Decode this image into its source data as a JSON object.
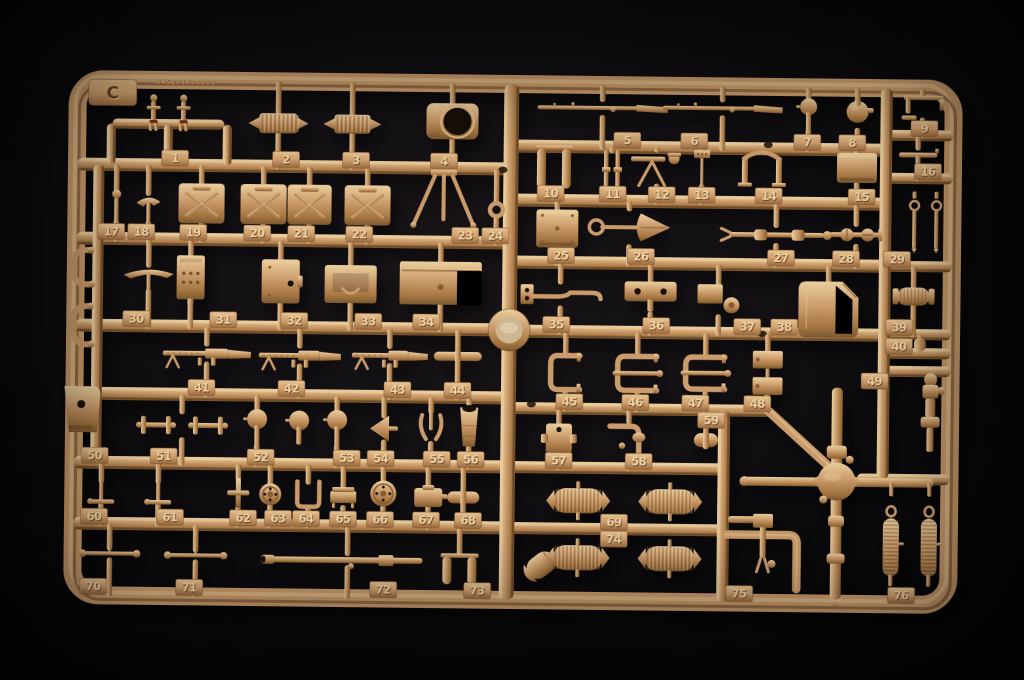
{
  "scene": {
    "title": "Photograph of a tan plastic model-kit sprue (parts tree) on a black background",
    "description": "Sand-tan injection-moulded sprue C holding numbered model parts 1 to 76"
  },
  "sprue": {
    "letter": "C",
    "embossed_code": "845291845293",
    "colors": {
      "plastic_light": "#eccf9e",
      "plastic_mid": "#cb9c6b",
      "plastic_dark": "#a3743f",
      "plastic_deep": "#7c5930",
      "tab_hi": "#e2bb87",
      "tab_light": "#d1a271",
      "tab_dark": "#9a6c3e",
      "rail_shade": "#4e3119",
      "engrave": "#684222",
      "engrave_hi": "#e8c48e",
      "digit_light": "#eed2a2",
      "digit_dark": "#6d452a",
      "accent_red": "#7e2818",
      "hole": "#171007",
      "boss_inner": "#cdb692",
      "background": "#0a090b"
    },
    "frame": {
      "x": 75,
      "y": 84,
      "w": 876,
      "h": 516,
      "rx": 26,
      "thickness": 18,
      "tilt_deg": 0.65
    },
    "boss": {
      "x": 509,
      "y": 330
    },
    "holes": [
      {
        "x": 501,
        "y": 170
      },
      {
        "x": 766,
        "y": 142
      },
      {
        "x": 762,
        "y": 331
      },
      {
        "x": 532,
        "y": 404
      }
    ],
    "rails_h": [
      {
        "x": 110,
        "y": 128,
        "len": 112,
        "w": 10
      },
      {
        "x": 75,
        "y": 169,
        "len": 434,
        "w": 13
      },
      {
        "x": 75,
        "y": 243,
        "len": 434,
        "w": 13
      },
      {
        "x": 75,
        "y": 330,
        "len": 434,
        "w": 13
      },
      {
        "x": 75,
        "y": 398,
        "len": 434,
        "w": 13
      },
      {
        "x": 75,
        "y": 467,
        "len": 434,
        "w": 13
      },
      {
        "x": 75,
        "y": 528,
        "len": 434,
        "w": 13
      },
      {
        "x": 509,
        "y": 146,
        "len": 375,
        "w": 13
      },
      {
        "x": 509,
        "y": 200,
        "len": 375,
        "w": 13
      },
      {
        "x": 509,
        "y": 262,
        "len": 375,
        "w": 13
      },
      {
        "x": 509,
        "y": 331,
        "len": 375,
        "w": 13
      },
      {
        "x": 509,
        "y": 408,
        "len": 263,
        "w": 12
      },
      {
        "x": 509,
        "y": 467,
        "len": 222,
        "w": 12
      },
      {
        "x": 509,
        "y": 528,
        "len": 222,
        "w": 12
      },
      {
        "x": 884,
        "y": 131,
        "len": 67,
        "w": 11
      },
      {
        "x": 884,
        "y": 174,
        "len": 67,
        "w": 11
      },
      {
        "x": 884,
        "y": 262,
        "len": 67,
        "w": 11
      },
      {
        "x": 884,
        "y": 330,
        "len": 67,
        "w": 11
      },
      {
        "x": 884,
        "y": 349,
        "len": 67,
        "w": 11
      },
      {
        "x": 884,
        "y": 367,
        "len": 67,
        "w": 11
      },
      {
        "x": 858,
        "y": 475,
        "len": 93,
        "w": 11
      }
    ],
    "rails_v": [
      {
        "x": 509,
        "y": 84,
        "len": 516,
        "w": 15
      },
      {
        "x": 884,
        "y": 84,
        "len": 391,
        "w": 12
      },
      {
        "x": 97,
        "y": 169,
        "len": 298,
        "w": 11
      },
      {
        "x": 725,
        "y": 408,
        "len": 192,
        "w": 12
      },
      {
        "x": 109,
        "y": 128,
        "len": 41,
        "w": 9
      },
      {
        "x": 166,
        "y": 128,
        "len": 41,
        "w": 9
      },
      {
        "x": 225,
        "y": 128,
        "len": 41,
        "w": 9
      }
    ],
    "rail_diag": {
      "x1": 768,
      "y1": 407,
      "x2": 836,
      "y2": 468,
      "w": 9
    },
    "parts": [
      {
        "n": 1,
        "t": "figures2",
        "x": 168,
        "y": 116,
        "w": 62,
        "h": 38,
        "ry": 169,
        "tx": 173,
        "ns": 1
      },
      {
        "n": 2,
        "t": "spring_h",
        "x": 276,
        "y": 126,
        "w": 60,
        "h": 20,
        "ry": 169,
        "tx": 284,
        "up": 84
      },
      {
        "n": 3,
        "t": "spring_h",
        "x": 350,
        "y": 126,
        "w": 58,
        "h": 19,
        "ry": 169,
        "tx": 354,
        "up": 84
      },
      {
        "n": 4,
        "t": "cupola",
        "x": 450,
        "y": 122,
        "w": 52,
        "h": 36,
        "ry": 169,
        "tx": 442,
        "up": 84
      },
      {
        "n": 5,
        "t": "rifle",
        "x": 600,
        "y": 107,
        "w": 130,
        "h": 18,
        "ry": 146,
        "tx": 625,
        "up": 84
      },
      {
        "n": 6,
        "t": "rifle",
        "x": 720,
        "y": 106,
        "w": 120,
        "h": 18,
        "ry": 146,
        "tx": 692,
        "up": 84
      },
      {
        "n": 7,
        "t": "ballstem",
        "x": 806,
        "y": 111,
        "w": 17,
        "h": 32,
        "ry": 146,
        "tx": 805,
        "up": 84
      },
      {
        "n": 8,
        "t": "grenade",
        "x": 855,
        "y": 110,
        "w": 26,
        "h": 32,
        "ry": 146,
        "tx": 850,
        "up": 84
      },
      {
        "n": 9,
        "t": "periscope",
        "x": 920,
        "y": 103,
        "w": 48,
        "h": 24,
        "ry": 131,
        "tx": 922,
        "up": 84
      },
      {
        "n": 10,
        "t": "twincyl",
        "x": 552,
        "y": 167,
        "w": 38,
        "h": 44,
        "ry": 200,
        "tx": 549,
        "up": 146,
        "ns": 1
      },
      {
        "n": 11,
        "t": "pins",
        "x": 610,
        "y": 169,
        "w": 28,
        "h": 40,
        "ry": 200,
        "tx": 611,
        "up": 146,
        "ns": 1
      },
      {
        "n": 12,
        "t": "mgmount",
        "x": 655,
        "y": 166,
        "w": 52,
        "h": 36,
        "ry": 200,
        "tx": 660,
        "up": 146
      },
      {
        "n": 13,
        "t": "flag",
        "x": 700,
        "y": 166,
        "w": 22,
        "h": 36,
        "ry": 200,
        "tx": 700,
        "up": 146
      },
      {
        "n": 14,
        "t": "ubracket",
        "x": 760,
        "y": 165,
        "w": 54,
        "h": 38,
        "ry": 200,
        "tx": 767,
        "up": 146,
        "ns": 1
      },
      {
        "n": 15,
        "t": "boxp",
        "x": 855,
        "y": 164,
        "w": 40,
        "h": 30,
        "ry": 200,
        "tx": 860,
        "up": 146
      },
      {
        "n": 16,
        "t": "tpart",
        "x": 916,
        "y": 153,
        "w": 44,
        "h": 20,
        "ry": 174,
        "tx": 926,
        "up": 131
      },
      {
        "n": 17,
        "t": "smallpin",
        "x": 115,
        "y": 210,
        "w": 14,
        "h": 32,
        "ry": 243,
        "tx": 110,
        "up": 169
      },
      {
        "n": 18,
        "t": "pick",
        "x": 147,
        "y": 212,
        "w": 24,
        "h": 30,
        "ry": 243,
        "tx": 140,
        "up": 169
      },
      {
        "n": 19,
        "t": "jerrycan",
        "x": 200,
        "y": 207,
        "w": 46,
        "h": 40,
        "ry": 243,
        "tx": 192,
        "up": 169
      },
      {
        "n": 20,
        "t": "jerrycan",
        "x": 262,
        "y": 207,
        "w": 46,
        "h": 40,
        "ry": 243,
        "tx": 256,
        "up": 169
      },
      {
        "n": 21,
        "t": "jerrycan",
        "x": 308,
        "y": 207,
        "w": 44,
        "h": 40,
        "ry": 243,
        "tx": 300,
        "up": 169
      },
      {
        "n": 22,
        "t": "jerrycan",
        "x": 366,
        "y": 207,
        "w": 46,
        "h": 40,
        "ry": 243,
        "tx": 358,
        "up": 169
      },
      {
        "n": 23,
        "t": "tripod",
        "x": 442,
        "y": 198,
        "w": 68,
        "h": 56,
        "ry": 243,
        "tx": 464,
        "up": 169,
        "ns": 1
      },
      {
        "n": 24,
        "t": "ring",
        "x": 495,
        "y": 210,
        "w": 17,
        "h": 17,
        "ry": 243,
        "tx": 494,
        "up": 169
      },
      {
        "n": 25,
        "t": "rivetbox",
        "x": 556,
        "y": 228,
        "w": 42,
        "h": 38,
        "ry": 262,
        "tx": 560,
        "up": 200
      },
      {
        "n": 26,
        "t": "shovel",
        "x": 628,
        "y": 226,
        "w": 82,
        "h": 38,
        "ry": 262,
        "tx": 640,
        "up": 200
      },
      {
        "n": 27,
        "t": "linkage",
        "x": 775,
        "y": 232,
        "w": 110,
        "h": 20,
        "ry": 262,
        "tx": 780,
        "up": 200
      },
      {
        "n": 28,
        "t": "axlejoint",
        "x": 855,
        "y": 231,
        "w": 52,
        "h": 22,
        "ry": 262,
        "tx": 845,
        "up": 200
      },
      {
        "n": 29,
        "t": "eyebolts",
        "x": 924,
        "y": 222,
        "w": 40,
        "h": 52,
        "ry": 262,
        "tx": 896,
        "ns": 1
      },
      {
        "n": 30,
        "t": "pick",
        "x": 148,
        "y": 282,
        "w": 50,
        "h": 26,
        "ry": 330,
        "tx": 136,
        "up": 243
      },
      {
        "n": 31,
        "t": "radio",
        "x": 190,
        "y": 281,
        "w": 28,
        "h": 44,
        "ry": 330,
        "tx": 223,
        "up": 243
      },
      {
        "n": 32,
        "t": "hatch",
        "x": 280,
        "y": 284,
        "w": 38,
        "h": 44,
        "ry": 330,
        "tx": 294,
        "up": 243
      },
      {
        "n": 33,
        "t": "hatch2",
        "x": 350,
        "y": 286,
        "w": 52,
        "h": 38,
        "ry": 330,
        "tx": 368,
        "up": 243
      },
      {
        "n": 34,
        "t": "bin",
        "x": 440,
        "y": 284,
        "w": 82,
        "h": 43,
        "ry": 330,
        "tx": 426,
        "up": 243
      },
      {
        "n": 35,
        "t": "pipe",
        "x": 560,
        "y": 294,
        "w": 80,
        "h": 26,
        "ry": 331,
        "tx": 556,
        "up": 262
      },
      {
        "n": 36,
        "t": "holeplate",
        "x": 650,
        "y": 296,
        "w": 52,
        "h": 32,
        "ry": 331,
        "tx": 656,
        "up": 262
      },
      {
        "n": 37,
        "t": "wheelplate",
        "x": 718,
        "y": 298,
        "w": 42,
        "h": 32,
        "ry": 331,
        "tx": 747,
        "up": 262
      },
      {
        "n": 38,
        "t": "bigcan",
        "x": 828,
        "y": 306,
        "w": 60,
        "h": 56,
        "ry": 331,
        "tx": 784,
        "up": 262,
        "ns": 1
      },
      {
        "n": 39,
        "t": "ribadapter",
        "x": 913,
        "y": 292,
        "w": 42,
        "h": 18,
        "ry": 330,
        "tx": 899,
        "up": 262
      },
      {
        "n": 40,
        "t": "pin40",
        "x": 920,
        "y": 340,
        "w": 12,
        "h": 14,
        "ry": 349,
        "tx": 899,
        "up": 330
      },
      {
        "n": 41,
        "t": "mg",
        "x": 207,
        "y": 357,
        "w": 88,
        "h": 20,
        "ry": 398,
        "tx": 202,
        "up": 330
      },
      {
        "n": 42,
        "t": "mg",
        "x": 300,
        "y": 358,
        "w": 82,
        "h": 20,
        "ry": 398,
        "tx": 292,
        "up": 330
      },
      {
        "n": 43,
        "t": "mg",
        "x": 390,
        "y": 357,
        "w": 76,
        "h": 19,
        "ry": 398,
        "tx": 398,
        "up": 330
      },
      {
        "n": 44,
        "t": "rodshort",
        "x": 458,
        "y": 357,
        "w": 48,
        "h": 9,
        "ry": 398,
        "tx": 458,
        "up": 330
      },
      {
        "n": 45,
        "t": "cclamp",
        "x": 566,
        "y": 372,
        "w": 34,
        "h": 40,
        "ry": 408,
        "tx": 570,
        "up": 331
      },
      {
        "n": 46,
        "t": "clamp2",
        "x": 638,
        "y": 372,
        "w": 44,
        "h": 40,
        "ry": 408,
        "tx": 636,
        "up": 331
      },
      {
        "n": 47,
        "t": "clamp2",
        "x": 706,
        "y": 371,
        "w": 44,
        "h": 38,
        "ry": 408,
        "tx": 696,
        "up": 331
      },
      {
        "n": 48,
        "t": "dblbracket",
        "x": 768,
        "y": 370,
        "w": 30,
        "h": 44,
        "ry": 408,
        "tx": 758,
        "up": 331
      },
      {
        "n": 49,
        "t": "turnpiece",
        "x": 931,
        "y": 408,
        "w": 26,
        "h": 78,
        "ry": 367,
        "tx": 875,
        "tb": 1,
        "ns": 1
      },
      {
        "n": 50,
        "t": "bracket",
        "x": 83,
        "y": 414,
        "w": 36,
        "h": 46,
        "ry": 467,
        "tx": 96,
        "ns": 1
      },
      {
        "n": 51,
        "t": "hbars",
        "x": 183,
        "y": 429,
        "w": 96,
        "h": 28,
        "ry": 467,
        "tx": 165,
        "up": 398
      },
      {
        "n": 52,
        "t": "ballstem",
        "x": 258,
        "y": 430,
        "w": 22,
        "h": 36,
        "ry": 467,
        "tx": 262,
        "up": 398
      },
      {
        "n": 53,
        "t": "ballstem",
        "x": 338,
        "y": 430,
        "w": 20,
        "h": 36,
        "ry": 467,
        "tx": 348,
        "up": 398
      },
      {
        "n": 54,
        "t": "funnel",
        "x": 385,
        "y": 430,
        "w": 28,
        "h": 26,
        "ry": 467,
        "tx": 382,
        "up": 398
      },
      {
        "n": 55,
        "t": "claw",
        "x": 432,
        "y": 428,
        "w": 30,
        "h": 32,
        "ry": 467,
        "tx": 438,
        "up": 398
      },
      {
        "n": 56,
        "t": "muzzle",
        "x": 470,
        "y": 426,
        "w": 28,
        "h": 42,
        "ry": 467,
        "tx": 472,
        "up": 398
      },
      {
        "n": 57,
        "t": "jbox",
        "x": 560,
        "y": 438,
        "w": 36,
        "h": 30,
        "ry": 467,
        "tx": 560,
        "up": 408
      },
      {
        "n": 58,
        "t": "elbow2",
        "x": 630,
        "y": 437,
        "w": 38,
        "h": 34,
        "ry": 467,
        "tx": 640,
        "up": 408
      },
      {
        "n": 59,
        "t": "rodshort",
        "x": 707,
        "y": 438,
        "w": 24,
        "h": 14,
        "ry": 408,
        "tx": 712,
        "tb": 1,
        "up": 414
      },
      {
        "n": 60,
        "t": "lever",
        "x": 103,
        "y": 497,
        "w": 26,
        "h": 24,
        "ry": 528,
        "tx": 96,
        "up": 467
      },
      {
        "n": 61,
        "t": "lever",
        "x": 160,
        "y": 497,
        "w": 26,
        "h": 24,
        "ry": 528,
        "tx": 172,
        "up": 467
      },
      {
        "n": 62,
        "t": "cross",
        "x": 240,
        "y": 496,
        "w": 22,
        "h": 30,
        "ry": 528,
        "tx": 245,
        "up": 467
      },
      {
        "n": 63,
        "t": "wheelsm",
        "x": 272,
        "y": 497,
        "w": 22,
        "h": 22,
        "ry": 528,
        "tx": 280,
        "up": 467
      },
      {
        "n": 64,
        "t": "ubend",
        "x": 310,
        "y": 497,
        "w": 26,
        "h": 26,
        "ry": 528,
        "tx": 308,
        "up": 467
      },
      {
        "n": 65,
        "t": "pan",
        "x": 345,
        "y": 499,
        "w": 26,
        "h": 20,
        "ry": 528,
        "tx": 345,
        "up": 467
      },
      {
        "n": 66,
        "t": "wheelsm",
        "x": 385,
        "y": 495,
        "w": 26,
        "h": 26,
        "ry": 528,
        "tx": 382,
        "up": 467
      },
      {
        "n": 67,
        "t": "pot",
        "x": 430,
        "y": 497,
        "w": 28,
        "h": 22,
        "ry": 528,
        "tx": 428,
        "up": 467
      },
      {
        "n": 68,
        "t": "rodshort",
        "x": 465,
        "y": 498,
        "w": 32,
        "h": 12,
        "ry": 528,
        "tx": 470,
        "up": 467
      },
      {
        "n": 69,
        "t": "drums2",
        "x": 626,
        "y": 500,
        "w": 160,
        "h": 25,
        "ry": 528,
        "tx": 616,
        "ns": 1
      },
      {
        "n": 70,
        "t": "rodball",
        "x": 112,
        "y": 558,
        "w": 60,
        "h": 12,
        "ry": 598,
        "tx": 96,
        "up": 528
      },
      {
        "n": 71,
        "t": "rodball",
        "x": 198,
        "y": 559,
        "w": 62,
        "h": 12,
        "ry": 598,
        "tx": 192,
        "up": 528
      },
      {
        "n": 72,
        "t": "barrel",
        "x": 350,
        "y": 562,
        "w": 172,
        "h": 14,
        "ry": 598,
        "tx": 386,
        "up": 528
      },
      {
        "n": 73,
        "t": "twincyl",
        "x": 462,
        "y": 570,
        "w": 38,
        "h": 32,
        "ry": 598,
        "tx": 480,
        "up": 528,
        "ns": 1
      },
      {
        "n": 74,
        "t": "drums2",
        "x": 626,
        "y": 557,
        "w": 160,
        "h": 25,
        "ry": 528,
        "tx": 616,
        "tb": 1,
        "ns": 1
      },
      {
        "n": 75,
        "t": "forkpart",
        "x": 765,
        "y": 540,
        "w": 26,
        "h": 58,
        "ry": 598,
        "tx": 742,
        "ns": 1
      },
      {
        "n": 76,
        "t": "springs2",
        "x": 912,
        "y": 540,
        "w": 58,
        "h": 76,
        "ry": 598,
        "tx": 904,
        "ns": 1
      }
    ],
    "extras": [
      {
        "t": "hook",
        "x": 83,
        "y": 272,
        "w": 26,
        "h": 42
      },
      {
        "t": "hook",
        "x": 83,
        "y": 330,
        "w": 26,
        "h": 46
      },
      {
        "t": "ballstem",
        "x": 300,
        "y": 430,
        "w": 20,
        "h": 34
      },
      {
        "t": "shell",
        "x": 541,
        "y": 567,
        "w": 38,
        "h": 22,
        "rot": -38
      },
      {
        "t": "stubh",
        "x": 748,
        "y": 517,
        "w": 36,
        "h": 7
      },
      {
        "t": "ltube",
        "x": 765,
        "y": 557,
        "w": 74,
        "h": 58
      },
      {
        "t": "diffaxle",
        "x": 838,
        "y": 490,
        "w": 190,
        "h": 212
      }
    ]
  }
}
